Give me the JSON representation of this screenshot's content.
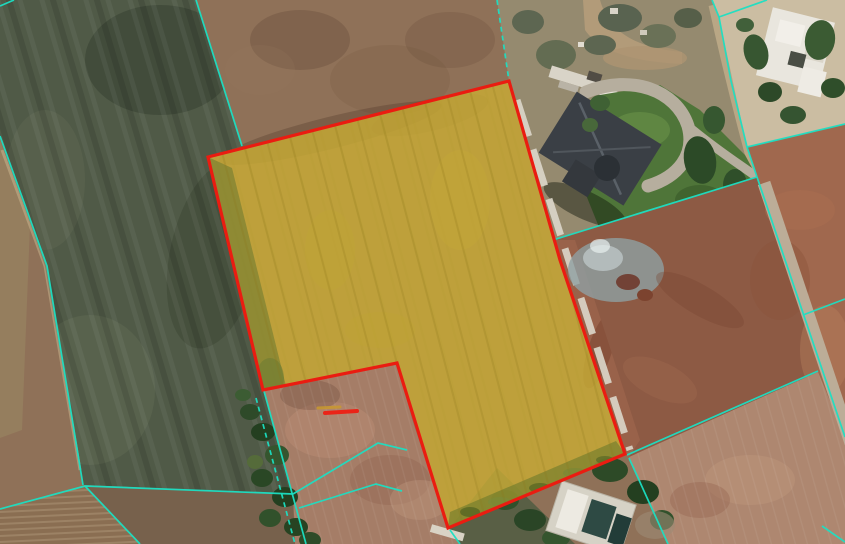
{
  "map": {
    "colors": {
      "boundary": "#ea1c11",
      "cadastral": "#1bdfc3",
      "parcel_fill": "#c9ad35",
      "parcel_fill_opacity": 0.8
    },
    "parcel": {
      "points": [
        [
          208,
          157
        ],
        [
          509,
          81
        ],
        [
          560,
          260
        ],
        [
          625,
          454
        ],
        [
          448,
          528
        ],
        [
          397,
          363
        ],
        [
          263,
          390
        ]
      ]
    },
    "cadastral_lines": [
      {
        "id": "nw-corner-tick",
        "points": [
          [
            0,
            6
          ],
          [
            14,
            0
          ]
        ],
        "dashed": false
      },
      {
        "id": "north-field-boundary",
        "points": [
          [
            196,
            0
          ],
          [
            242,
            146
          ]
        ],
        "dashed": false
      },
      {
        "id": "north-to-parcel-corner",
        "points": [
          [
            497,
            0
          ],
          [
            509,
            81
          ]
        ],
        "dashed": true
      },
      {
        "id": "west-long-boundary",
        "points": [
          [
            0,
            136
          ],
          [
            47,
            266
          ],
          [
            83,
            485
          ]
        ],
        "dashed": false
      },
      {
        "id": "southwest-horizontal",
        "points": [
          [
            0,
            509
          ],
          [
            85,
            486
          ],
          [
            293,
            494
          ]
        ],
        "dashed": false
      },
      {
        "id": "southwest-diagonal",
        "points": [
          [
            85,
            486
          ],
          [
            140,
            544
          ]
        ],
        "dashed": false
      },
      {
        "id": "south-fan-upper",
        "points": [
          [
            293,
            494
          ],
          [
            378,
            443
          ],
          [
            407,
            450
          ]
        ],
        "dashed": false
      },
      {
        "id": "south-fan-lower",
        "points": [
          [
            299,
            508
          ],
          [
            376,
            484
          ],
          [
            402,
            491
          ]
        ],
        "dashed": false
      },
      {
        "id": "south-vertical-a",
        "points": [
          [
            264,
            391
          ],
          [
            306,
            544
          ]
        ],
        "dashed": false
      },
      {
        "id": "south-vertical-b",
        "points": [
          [
            256,
            398
          ],
          [
            295,
            544
          ]
        ],
        "dashed": true
      },
      {
        "id": "house-parcel-east",
        "points": [
          [
            712,
            0
          ],
          [
            719,
            17
          ],
          [
            731,
            81
          ],
          [
            747,
            147
          ],
          [
            757,
            177
          ]
        ],
        "dashed": false
      },
      {
        "id": "house-parcel-ne-branch",
        "points": [
          [
            719,
            17
          ],
          [
            767,
            0
          ]
        ],
        "dashed": false
      },
      {
        "id": "east-branch-upper",
        "points": [
          [
            747,
            147
          ],
          [
            845,
            124
          ]
        ],
        "dashed": false
      },
      {
        "id": "house-parcel-south",
        "points": [
          [
            757,
            177
          ],
          [
            553,
            240
          ]
        ],
        "dashed": false
      },
      {
        "id": "east-road-boundary",
        "points": [
          [
            757,
            177
          ],
          [
            845,
            437
          ]
        ],
        "dashed": false
      },
      {
        "id": "east-branch-mid",
        "points": [
          [
            803,
            315
          ],
          [
            845,
            299
          ]
        ],
        "dashed": false
      },
      {
        "id": "southeast-diagonal",
        "points": [
          [
            627,
            455
          ],
          [
            818,
            371
          ]
        ],
        "dashed": false
      },
      {
        "id": "south-from-parcel-corner",
        "points": [
          [
            629,
            458
          ],
          [
            668,
            544
          ]
        ],
        "dashed": false
      },
      {
        "id": "south-stub",
        "points": [
          [
            450,
            530
          ],
          [
            460,
            544
          ]
        ],
        "dashed": false
      },
      {
        "id": "bottom-right-corner-line",
        "points": [
          [
            822,
            526
          ],
          [
            845,
            542
          ]
        ],
        "dashed": false
      }
    ],
    "markers": [
      {
        "id": "dash-marker-orange",
        "points": [
          [
            318,
            408
          ],
          [
            340,
            407
          ]
        ],
        "color": "#c9992f",
        "width": 3,
        "opacity": 0.85
      },
      {
        "id": "dash-marker-red",
        "points": [
          [
            325,
            413
          ],
          [
            357,
            411
          ]
        ],
        "color": "#ea2418",
        "width": 4,
        "opacity": 1
      }
    ]
  }
}
